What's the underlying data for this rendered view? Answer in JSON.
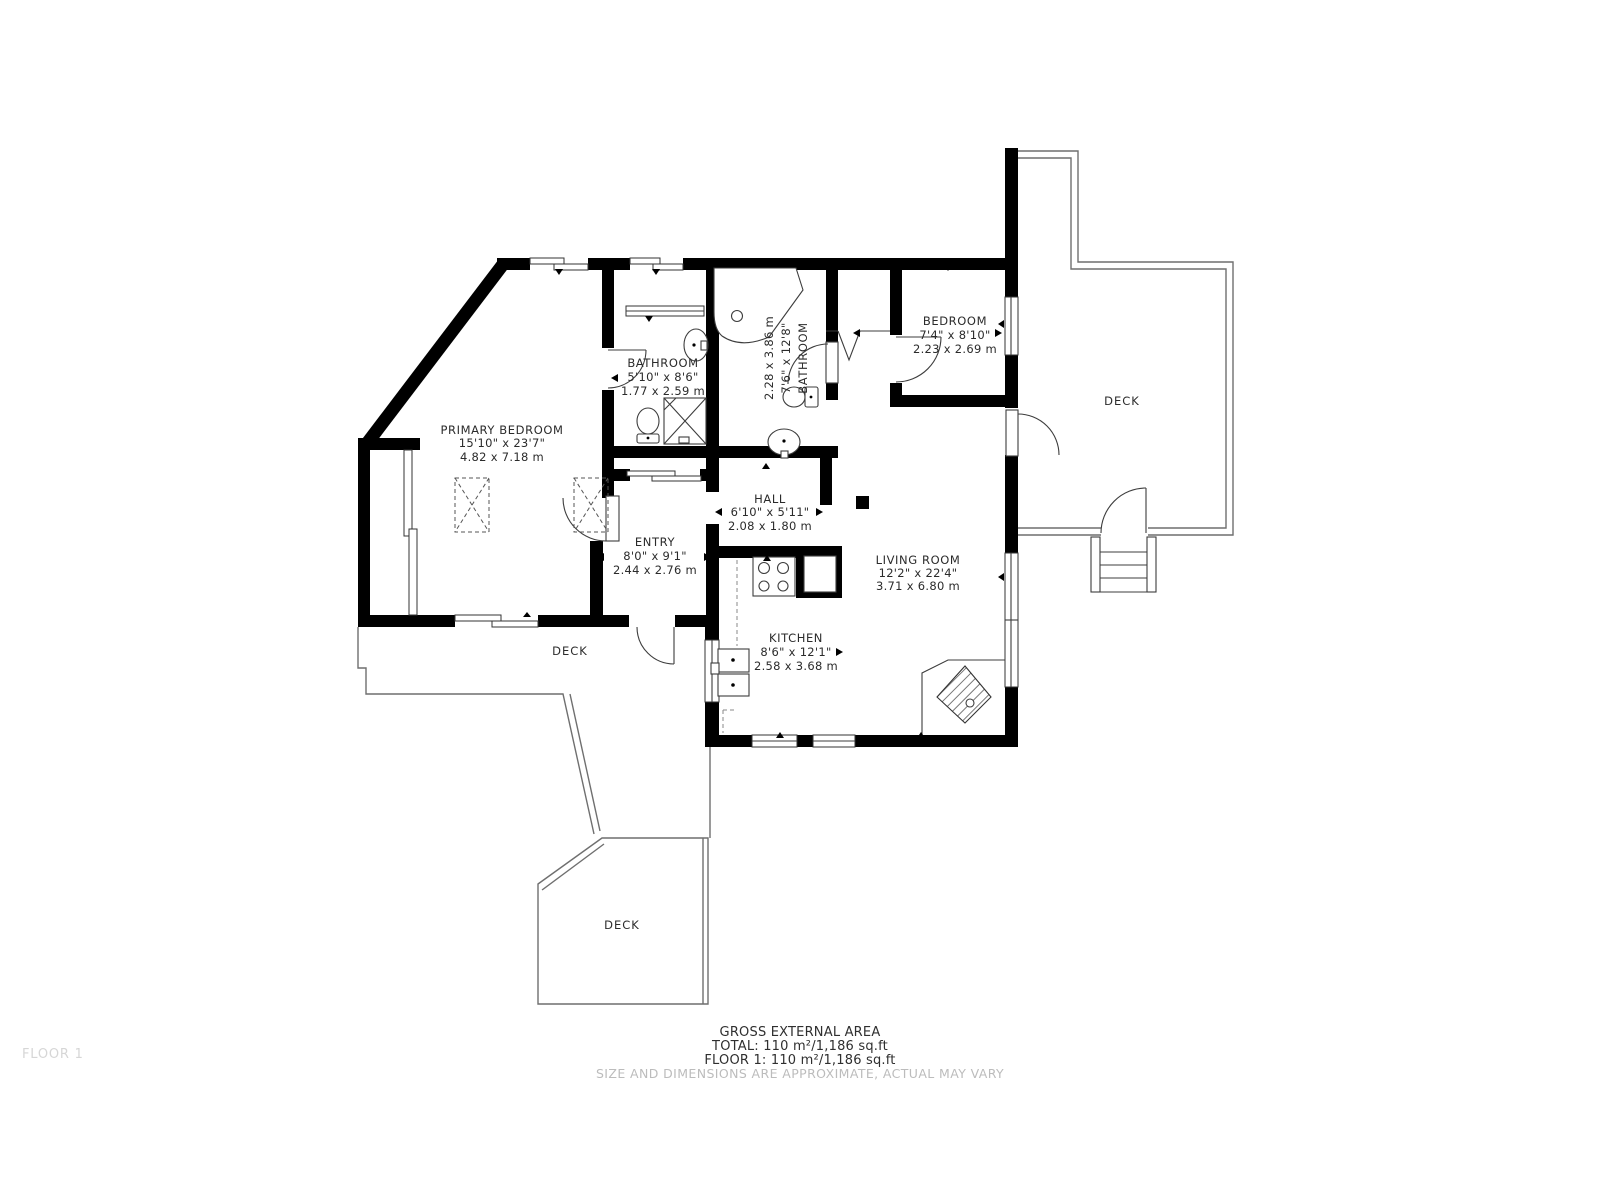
{
  "rooms": [
    {
      "name": "PRIMARY BEDROOM",
      "imperial": "15'10\" x 23'7\"",
      "metric": "4.82 x 7.18 m"
    },
    {
      "name": "BATHROOM",
      "imperial": "5'10\" x 8'6\"",
      "metric": "1.77 x 2.59 m"
    },
    {
      "name": "BATHROOM",
      "imperial": "7'6\" x 12'8\"",
      "metric": "2.28 x 3.86 m"
    },
    {
      "name": "BEDROOM",
      "imperial": "7'4\" x 8'10\"",
      "metric": "2.23 x 2.69 m"
    },
    {
      "name": "HALL",
      "imperial": "6'10\" x 5'11\"",
      "metric": "2.08 x 1.80 m"
    },
    {
      "name": "ENTRY",
      "imperial": "8'0\" x 9'1\"",
      "metric": "2.44 x 2.76 m"
    },
    {
      "name": "LIVING ROOM",
      "imperial": "12'2\" x 22'4\"",
      "metric": "3.71 x 6.80 m"
    },
    {
      "name": "KITCHEN",
      "imperial": "8'6\" x 12'1\"",
      "metric": "2.58 x 3.68 m"
    }
  ],
  "decks": {
    "upper": "DECK",
    "middle": "DECK",
    "lower": "DECK"
  },
  "footer": {
    "heading": "GROSS EXTERNAL AREA",
    "total": "TOTAL: 110 m²/1,186 sq.ft",
    "floor": "FLOOR 1: 110 m²/1,186 sq.ft",
    "disclaimer": "SIZE AND DIMENSIONS ARE APPROXIMATE, ACTUAL MAY VARY"
  },
  "floor_tag": "FLOOR 1",
  "colors": {
    "walls": "#000000",
    "thin_lines": "#3d3d3d",
    "deck_lines": "#6f6f6f",
    "label_text": "#2b2b2b",
    "muted_text": "#bcbcbc",
    "floor_tag_text": "#d6d6d6",
    "background": "#ffffff"
  }
}
